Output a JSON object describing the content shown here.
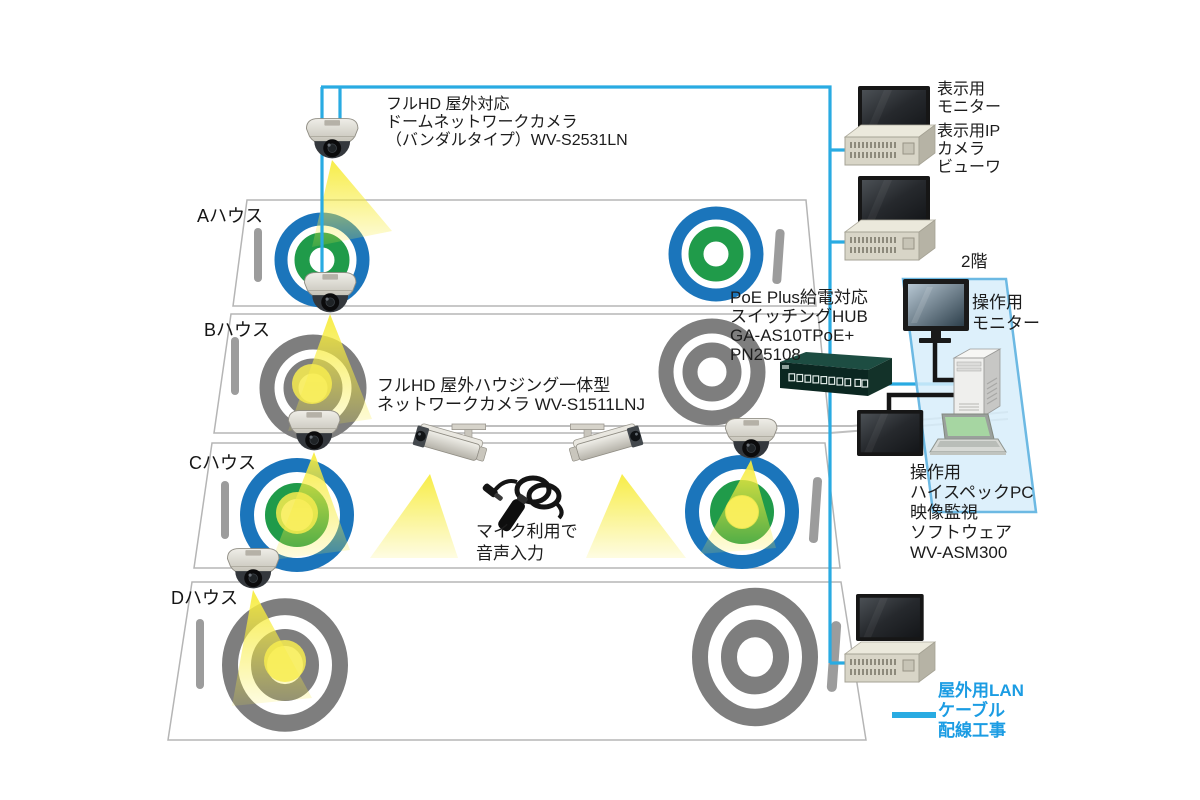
{
  "diagram": {
    "houses": [
      {
        "label": "Aハウス",
        "target_style": "blue-green"
      },
      {
        "label": "Bハウス",
        "target_style": "gray"
      },
      {
        "label": "Cハウス",
        "target_style": "blue-green"
      },
      {
        "label": "Dハウス",
        "target_style": "gray"
      }
    ],
    "annotations": {
      "dome_camera": [
        "フルHD 屋外対応",
        "ドームネットワークカメラ",
        "（バンダルタイプ）WV-S2531LN"
      ],
      "housing_camera": [
        "フルHD 屋外ハウジング一体型",
        "ネットワークカメラ WV-S1511LNJ"
      ],
      "microphone": [
        "マイク利用で",
        "音声入力"
      ],
      "poe_hub": [
        "PoE Plus給電対応",
        "スイッチングHUB",
        "GA-AS10TPoE+",
        "PN25108"
      ],
      "display_monitor": [
        "表示用",
        "モニター"
      ],
      "display_viewer": [
        "表示用IP",
        "カメラ",
        "ビューワ"
      ],
      "floor": "2階",
      "operation_monitor": [
        "操作用",
        "モニター"
      ],
      "operation_pc": [
        "操作用",
        "ハイスペックPC",
        "映像監視",
        "ソフトウェア",
        "WV-ASM300"
      ],
      "legend": [
        "屋外用LAN",
        "ケーブル",
        "配線工事"
      ]
    },
    "icons": {
      "dome_camera": "dome-camera-icon",
      "bullet_camera": "bullet-camera-icon",
      "microphone": "microphone-icon",
      "switch": "network-switch-icon",
      "monitor": "monitor-icon",
      "viewer_box": "ip-viewer-box-icon",
      "pc_tower": "pc-tower-icon",
      "laptop": "laptop-icon",
      "target": "camera-view-target-icon",
      "light_cone": "light-cone-icon"
    },
    "colors": {
      "lan_cable": "#29abe2",
      "legend_text": "#1b9ce3",
      "target_blue": "#1b75bb",
      "target_green": "#209b4a",
      "target_gray": "#7e7e7e",
      "light_yellow": "#f7ec4f",
      "floor_panel": "#d7edfa",
      "floor_panel_border": "#6cb9e3",
      "switch_body": "#0b2721"
    }
  }
}
